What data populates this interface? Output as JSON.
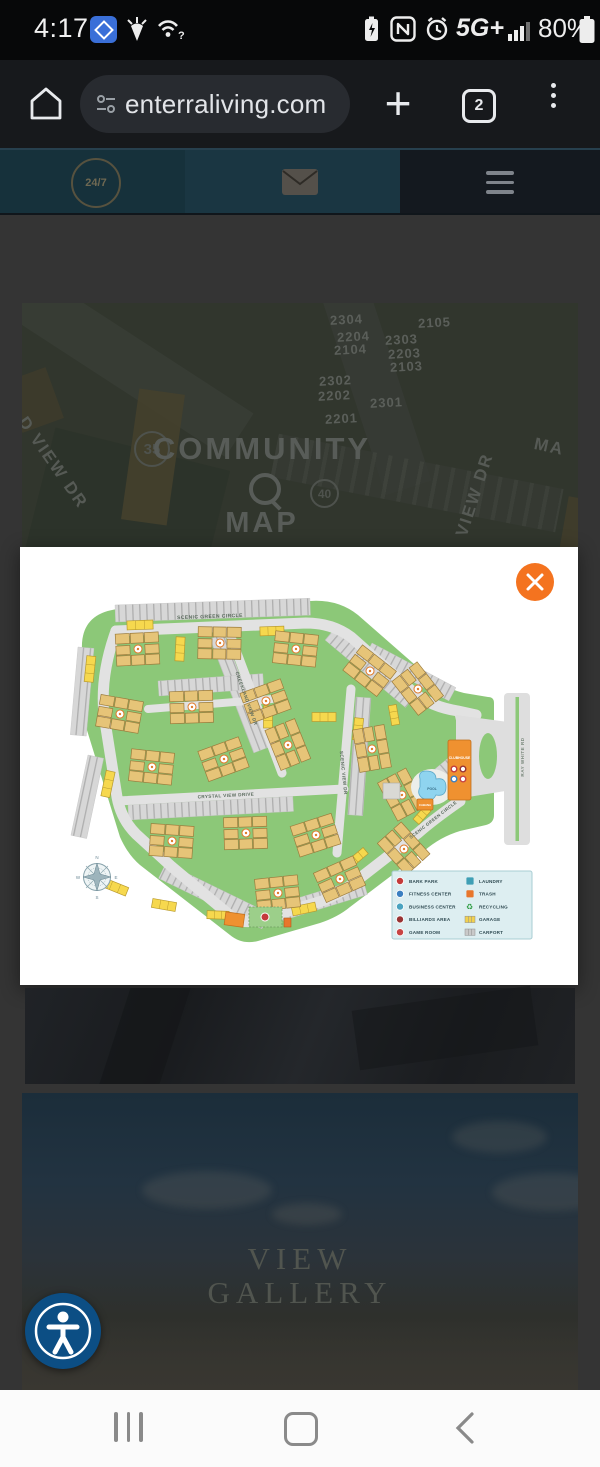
{
  "status_bar": {
    "time": "4:17",
    "battery_percent": "80%",
    "network": "5G+"
  },
  "browser": {
    "url": "enterraliving.com",
    "tab_count": "2"
  },
  "site_header": {
    "logo_text": "24/7"
  },
  "page_bg": {
    "units": [
      "2304",
      "2105",
      "2204",
      "2303",
      "2104",
      "2203",
      "2103",
      "2302",
      "2202",
      "2301",
      "2201"
    ],
    "badge_a": "35",
    "badge_b": "40",
    "title_top": "COMMUNITY",
    "title_bottom": "MAP",
    "street_left": "D VIEW DR",
    "street_right": "VIEW DR",
    "street_corner": "MA"
  },
  "map": {
    "streets": {
      "scenic_green_top": "SCENIC GREEN CIRCLE",
      "creekland": "CREEKLAND VIEW DR",
      "crystal": "CRYSTAL VIEW DRIVE",
      "scenic_view": "SCENIC VIEW DR",
      "scenic_green_bottom": "SCENIC GREEN CIRCLE",
      "ray_white": "RAY WHITE RD"
    },
    "places": {
      "clubhouse": "CLUBHOUSE",
      "pool": "POOL",
      "cabana": "CABANA"
    },
    "compass": {
      "n": "N",
      "e": "E",
      "s": "S",
      "w": "W"
    },
    "legend": {
      "col1": [
        {
          "label": "BARK PARK",
          "kind": "circle",
          "color": "#c43b3b"
        },
        {
          "label": "FITNESS CENTER",
          "kind": "circle",
          "color": "#3a7fc1"
        },
        {
          "label": "BUSINESS CENTER",
          "kind": "circle",
          "color": "#4aa3c0"
        },
        {
          "label": "BILLIARDS AREA",
          "kind": "circle",
          "color": "#993333"
        },
        {
          "label": "GAME ROOM",
          "kind": "circle",
          "color": "#c84444"
        }
      ],
      "col2": [
        {
          "label": "LAUNDRY",
          "kind": "square",
          "color": "#3f9fb5"
        },
        {
          "label": "TRASH",
          "kind": "square",
          "color": "#e8762c"
        },
        {
          "label": "RECYCLING",
          "kind": "recycle",
          "color": "#2f9e44"
        },
        {
          "label": "GARAGE",
          "kind": "garage",
          "color": "#f1d14f"
        },
        {
          "label": "CARPORT",
          "kind": "carport",
          "color": "#c9c9c9"
        }
      ]
    }
  },
  "gallery": {
    "title_top": "VIEW",
    "title_bottom": "GALLERY"
  }
}
